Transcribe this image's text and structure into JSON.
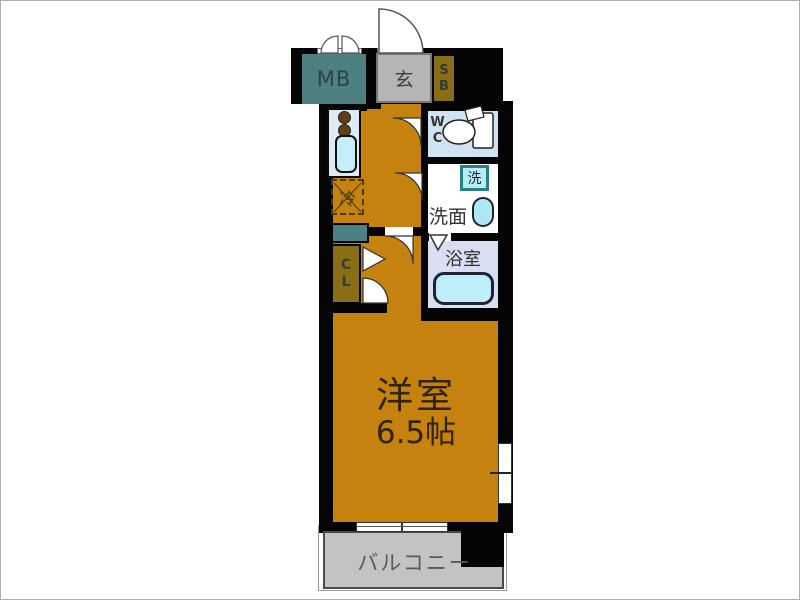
{
  "rooms": {
    "meter_box": "MB",
    "entrance": "玄",
    "shoe_box": "SB",
    "wc": "WC",
    "washroom": "洗面",
    "washer": "洗",
    "bathroom": "浴室",
    "closet": "CL",
    "refrigerator": "冷",
    "main_room_name": "洋室",
    "main_room_size": "6.5帖",
    "balcony": "バルコニー"
  },
  "colors": {
    "floor_orange": "#c5820e",
    "wall_black": "#050505",
    "teal_fixture": "#4d8080",
    "olive_storage": "#8a6e15",
    "entrance_gray": "#b5b5b5",
    "wc_floor": "#cfe3f2",
    "bathroom_floor": "#d9dff0",
    "water_fixture_cyan": "#b5ecf8",
    "balcony_gray": "#c3c3c3",
    "kitchen_counter": "#dcebf7"
  }
}
